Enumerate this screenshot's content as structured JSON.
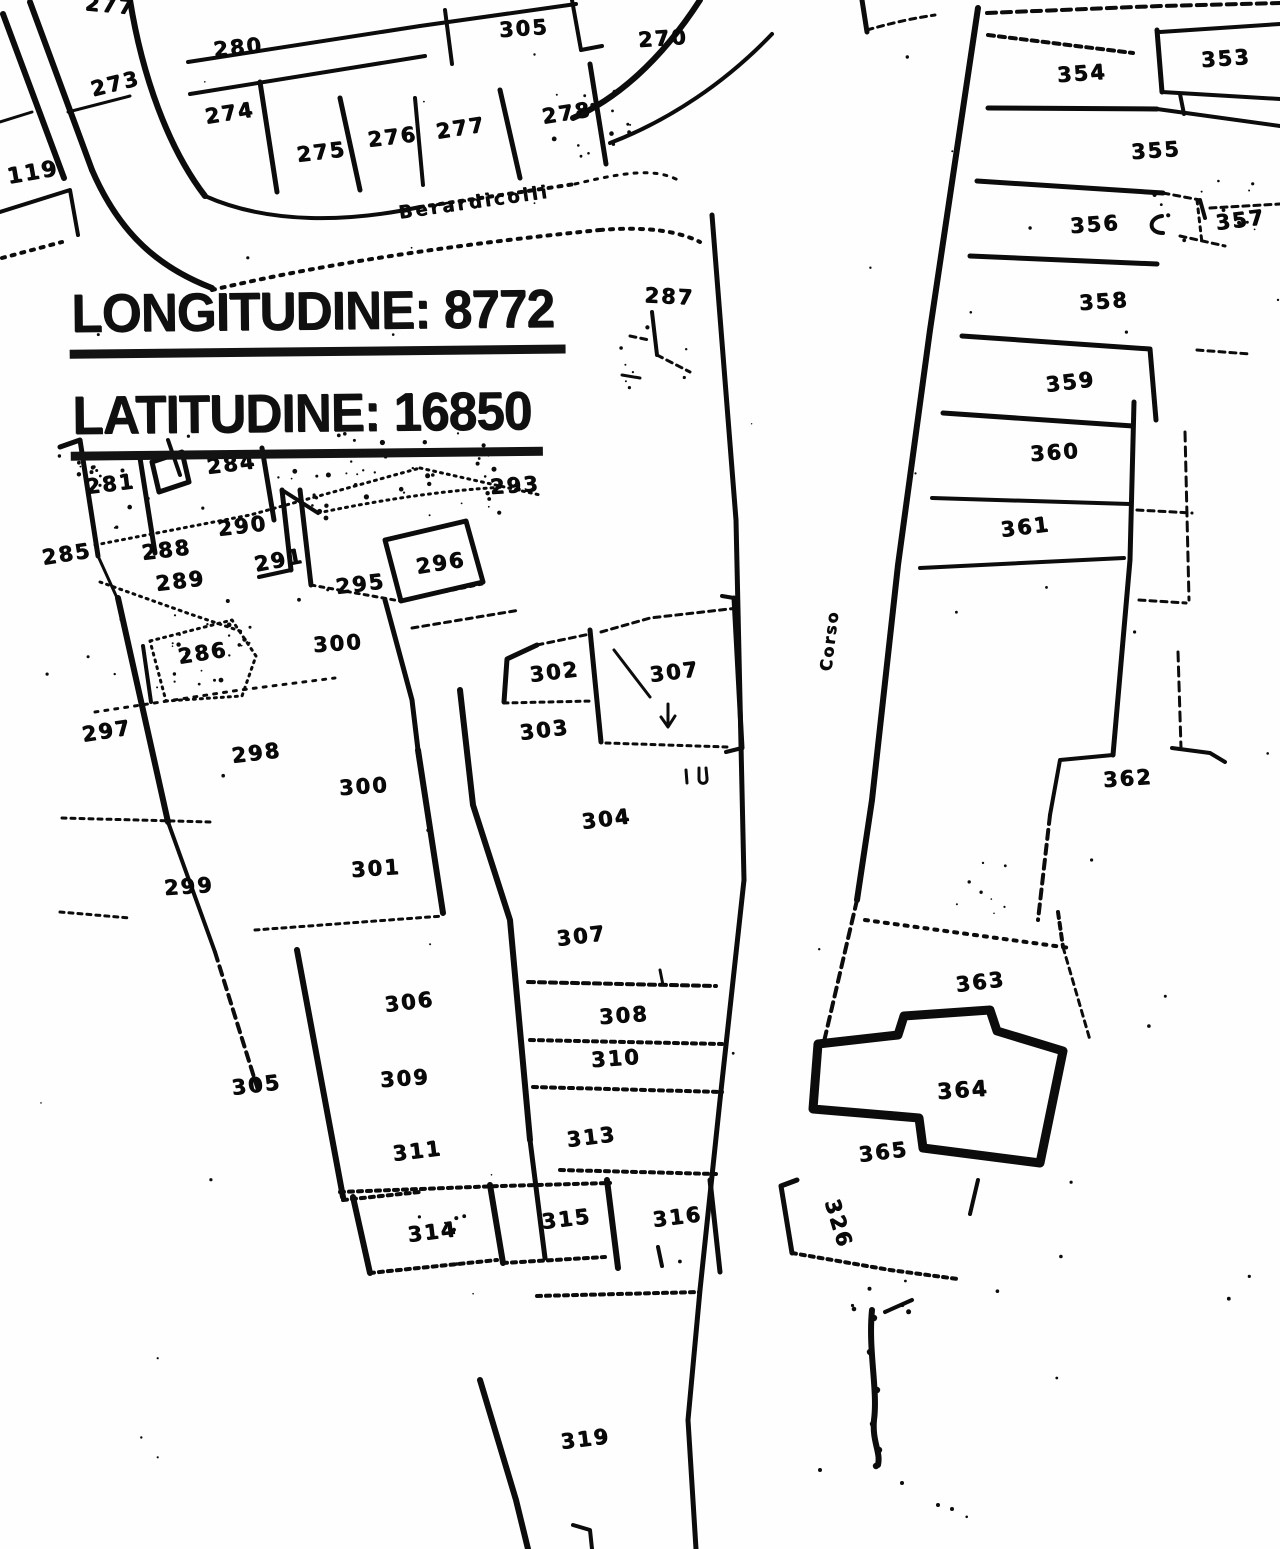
{
  "map": {
    "type": "cadastral-scan",
    "overlay": {
      "lines": [
        {
          "label": "LONGITUDINE:",
          "value": "8772"
        },
        {
          "label": "LATITUDINE:",
          "value": "16850"
        }
      ]
    },
    "streets": [
      {
        "name": "Berardicolli"
      },
      {
        "name": "Corso"
      }
    ],
    "highlighted_parcel": {
      "number": "364",
      "fill": "#b5b5b5"
    },
    "symbols": [
      {
        "name": "down-arrow-mark"
      },
      {
        "name": "u-mark"
      }
    ],
    "parcels": [
      {
        "n": "277",
        "x": 86,
        "y": -9,
        "r": 5
      },
      {
        "n": "273",
        "x": 88,
        "y": 78,
        "r": -14
      },
      {
        "n": "280",
        "x": 212,
        "y": 38,
        "r": -6
      },
      {
        "n": "305",
        "x": 498,
        "y": 18,
        "r": -4
      },
      {
        "n": "270",
        "x": 637,
        "y": 28,
        "r": -4
      },
      {
        "n": "274",
        "x": 203,
        "y": 105,
        "r": -9
      },
      {
        "n": "275",
        "x": 295,
        "y": 143,
        "r": -7
      },
      {
        "n": "276",
        "x": 366,
        "y": 128,
        "r": -7
      },
      {
        "n": "277",
        "x": 434,
        "y": 120,
        "r": -9
      },
      {
        "n": "278",
        "x": 540,
        "y": 105,
        "r": -9
      },
      {
        "n": "119",
        "x": 5,
        "y": 165,
        "r": -10,
        "s": 22
      },
      {
        "n": "287",
        "x": 645,
        "y": 283,
        "r": 3
      },
      {
        "n": "281",
        "x": 84,
        "y": 475,
        "r": -7
      },
      {
        "n": "284",
        "x": 205,
        "y": 455,
        "r": -7
      },
      {
        "n": "290",
        "x": 216,
        "y": 517,
        "r": -7
      },
      {
        "n": "288",
        "x": 140,
        "y": 541,
        "r": -7
      },
      {
        "n": "289",
        "x": 154,
        "y": 572,
        "r": -7
      },
      {
        "n": "291",
        "x": 252,
        "y": 553,
        "r": -11
      },
      {
        "n": "295",
        "x": 334,
        "y": 575,
        "r": -7
      },
      {
        "n": "296",
        "x": 414,
        "y": 555,
        "r": -9
      },
      {
        "n": "293",
        "x": 489,
        "y": 475,
        "r": -4
      },
      {
        "n": "285",
        "x": 40,
        "y": 546,
        "r": -9
      },
      {
        "n": "286",
        "x": 176,
        "y": 645,
        "r": -9
      },
      {
        "n": "300",
        "x": 312,
        "y": 633,
        "r": -4
      },
      {
        "n": "297",
        "x": 80,
        "y": 723,
        "r": -9
      },
      {
        "n": "298",
        "x": 230,
        "y": 744,
        "r": -7
      },
      {
        "n": "299",
        "x": 163,
        "y": 876,
        "r": -4
      },
      {
        "n": "300",
        "x": 338,
        "y": 776,
        "r": -4
      },
      {
        "n": "301",
        "x": 350,
        "y": 858,
        "r": -4
      },
      {
        "n": "302",
        "x": 528,
        "y": 663,
        "r": -7
      },
      {
        "n": "303",
        "x": 518,
        "y": 721,
        "r": -7
      },
      {
        "n": "307",
        "x": 648,
        "y": 663,
        "r": -7
      },
      {
        "n": "304",
        "x": 580,
        "y": 810,
        "r": -7
      },
      {
        "n": "307",
        "x": 555,
        "y": 927,
        "r": -7
      },
      {
        "n": "306",
        "x": 383,
        "y": 993,
        "r": -7
      },
      {
        "n": "305",
        "x": 230,
        "y": 1076,
        "r": -7
      },
      {
        "n": "309",
        "x": 379,
        "y": 1068,
        "r": -4
      },
      {
        "n": "308",
        "x": 598,
        "y": 1005,
        "r": -4
      },
      {
        "n": "310",
        "x": 590,
        "y": 1048,
        "r": -4
      },
      {
        "n": "311",
        "x": 391,
        "y": 1142,
        "r": -7
      },
      {
        "n": "313",
        "x": 565,
        "y": 1128,
        "r": -7
      },
      {
        "n": "314",
        "x": 406,
        "y": 1223,
        "r": -7
      },
      {
        "n": "315",
        "x": 540,
        "y": 1210,
        "r": -7
      },
      {
        "n": "316",
        "x": 651,
        "y": 1208,
        "r": -7
      },
      {
        "n": "319",
        "x": 559,
        "y": 1430,
        "r": -7
      },
      {
        "n": "354",
        "x": 1056,
        "y": 63,
        "r": -4
      },
      {
        "n": "353",
        "x": 1200,
        "y": 48,
        "r": -4
      },
      {
        "n": "355",
        "x": 1130,
        "y": 140,
        "r": -4
      },
      {
        "n": "356",
        "x": 1069,
        "y": 214,
        "r": -4
      },
      {
        "n": "357",
        "x": 1214,
        "y": 211,
        "r": -7
      },
      {
        "n": "358",
        "x": 1078,
        "y": 291,
        "r": -4
      },
      {
        "n": "359",
        "x": 1044,
        "y": 373,
        "r": -7
      },
      {
        "n": "360",
        "x": 1029,
        "y": 442,
        "r": -4
      },
      {
        "n": "361",
        "x": 999,
        "y": 518,
        "r": -7
      },
      {
        "n": "362",
        "x": 1102,
        "y": 768,
        "r": -4
      },
      {
        "n": "363",
        "x": 954,
        "y": 973,
        "r": -7
      },
      {
        "n": "364",
        "x": 936,
        "y": 1080,
        "r": -4,
        "s": 22
      },
      {
        "n": "365",
        "x": 857,
        "y": 1143,
        "r": -7
      },
      {
        "n": "326",
        "x": 843,
        "y": 1196,
        "r": 73
      }
    ]
  }
}
